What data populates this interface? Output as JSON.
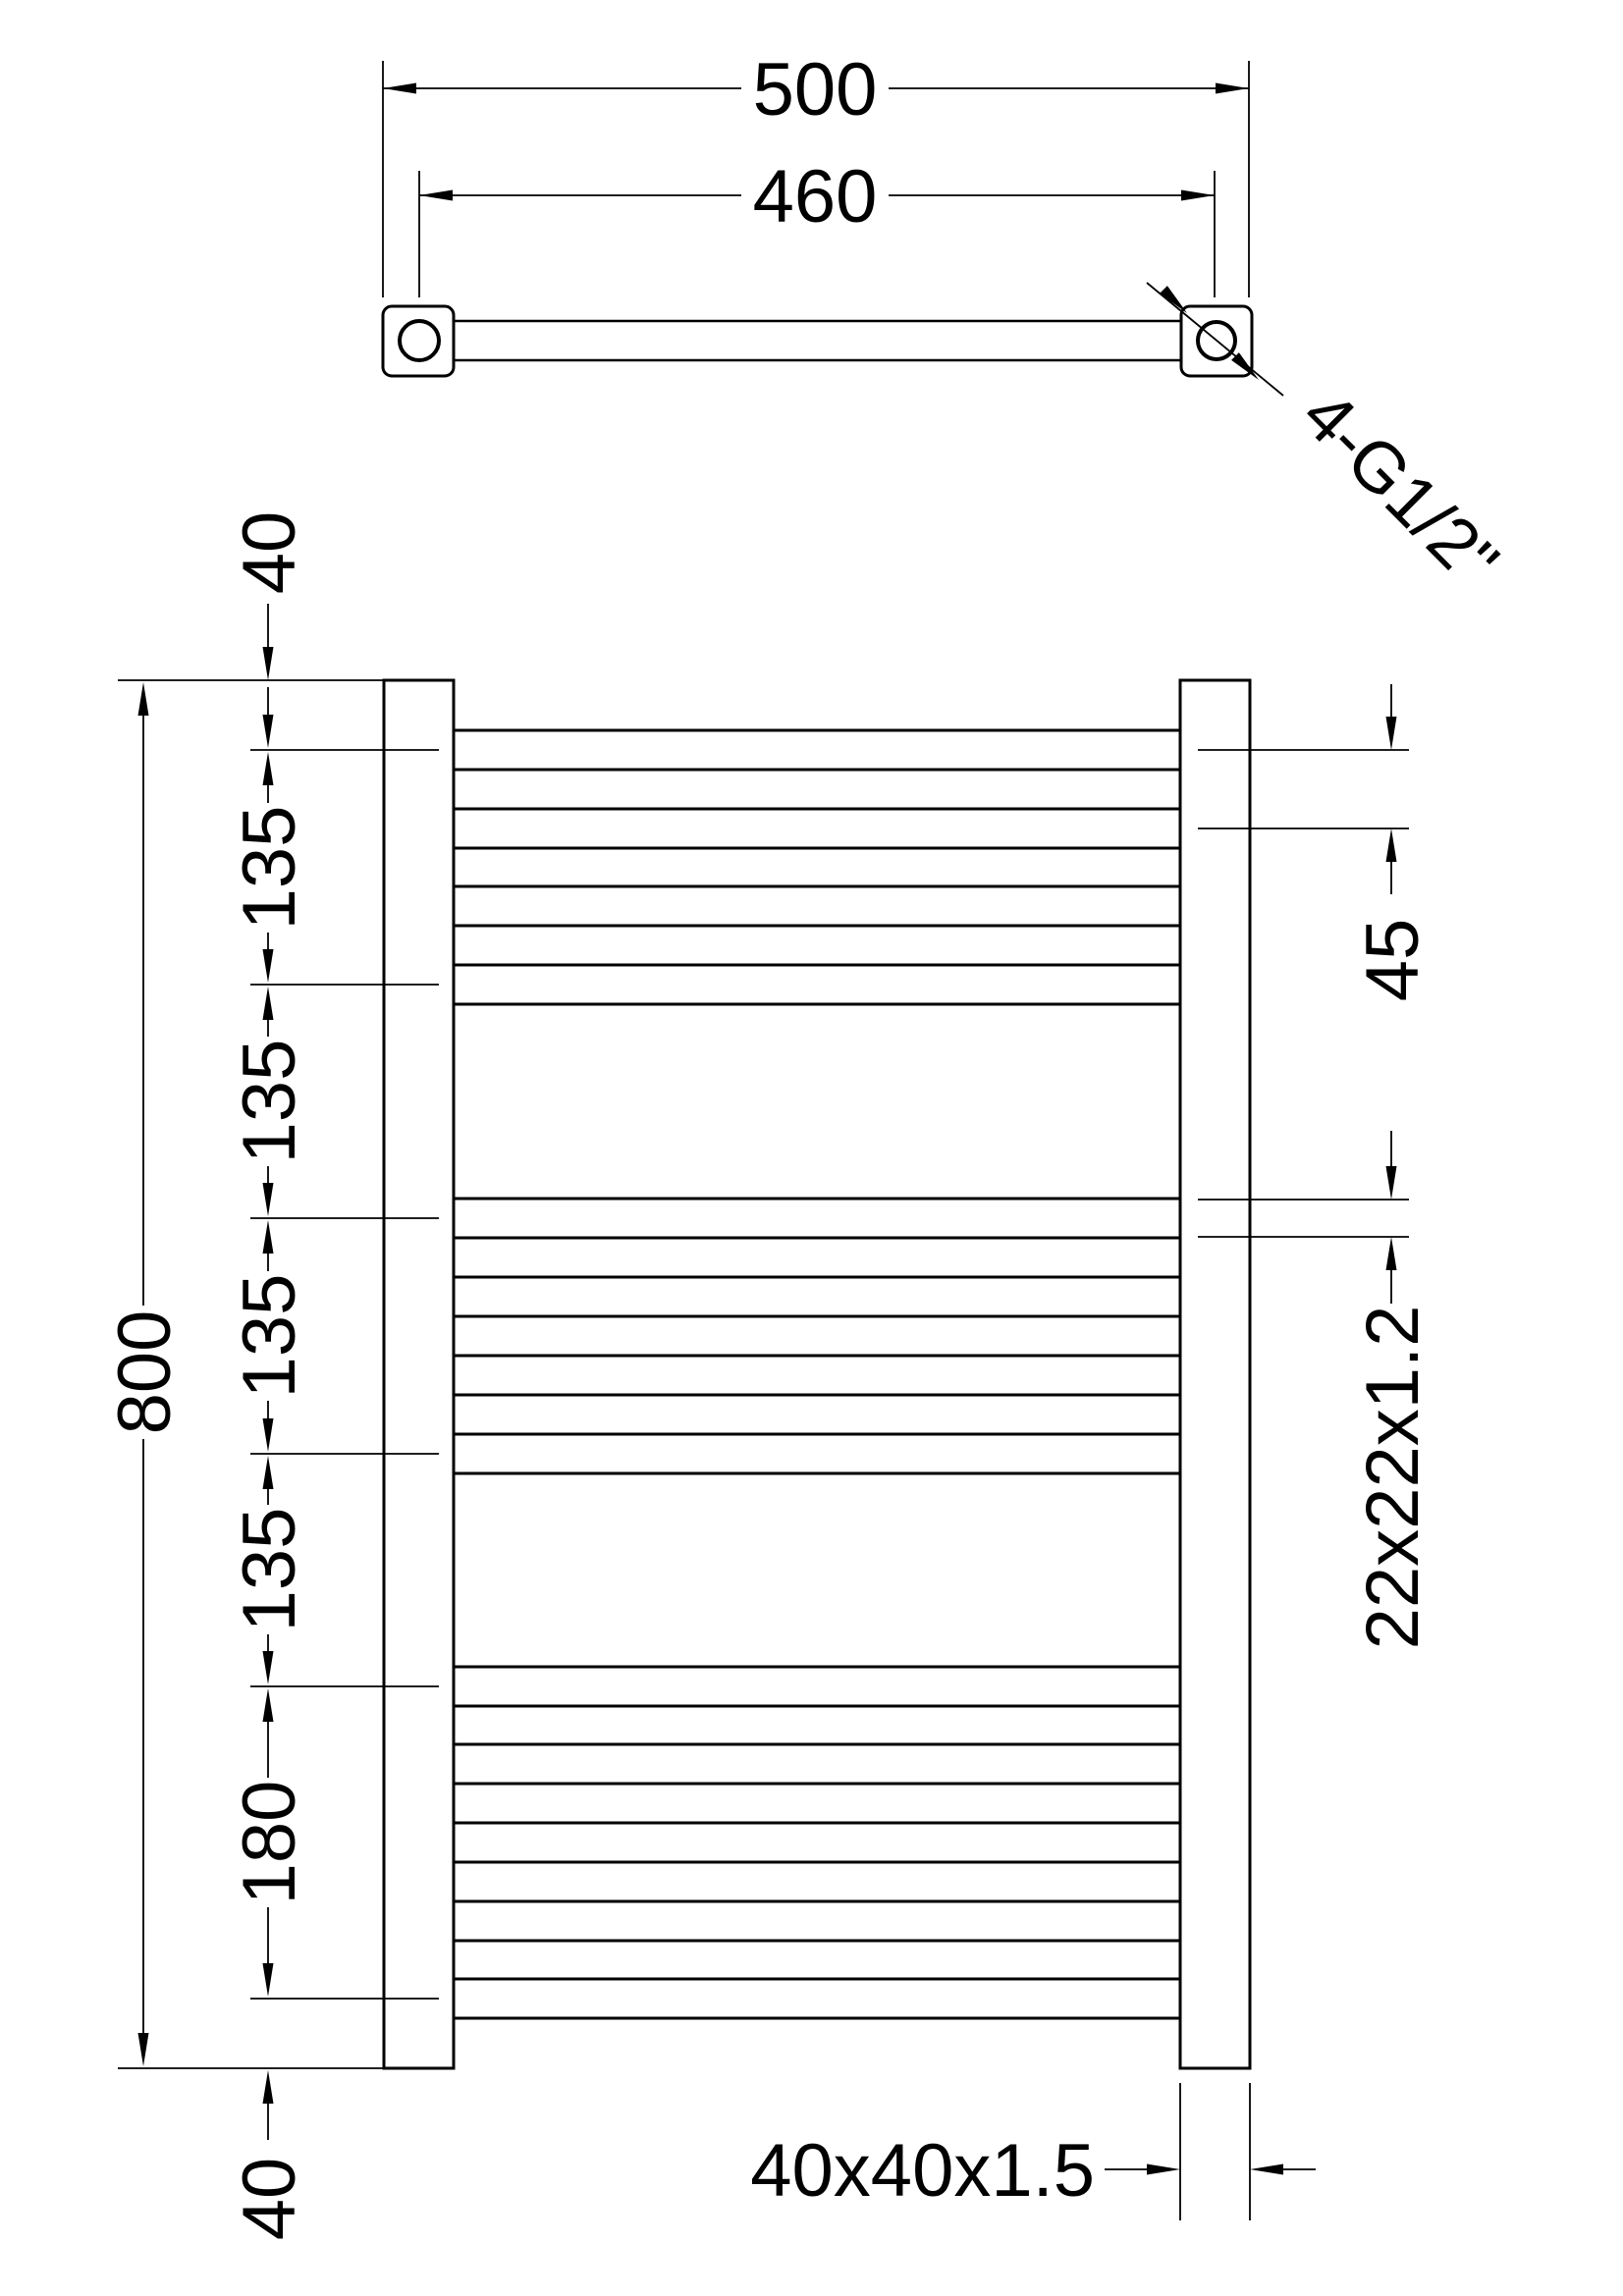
{
  "title": "Heated towel rail technical drawing",
  "colors": {
    "line": "#000000",
    "background": "#ffffff"
  },
  "top_view": {
    "overall_width": "500",
    "mounting_spacing": "460",
    "thread_callout": "4-G1/2\""
  },
  "front_view": {
    "overall_height": "800",
    "left_chain": [
      "40",
      "135",
      "135",
      "135",
      "135",
      "180",
      "40"
    ],
    "rung_pitch": "45",
    "tube_section": "22x22x1.2",
    "post_section": "40x40x1.5",
    "rung_groups": [
      4,
      4,
      5
    ]
  }
}
